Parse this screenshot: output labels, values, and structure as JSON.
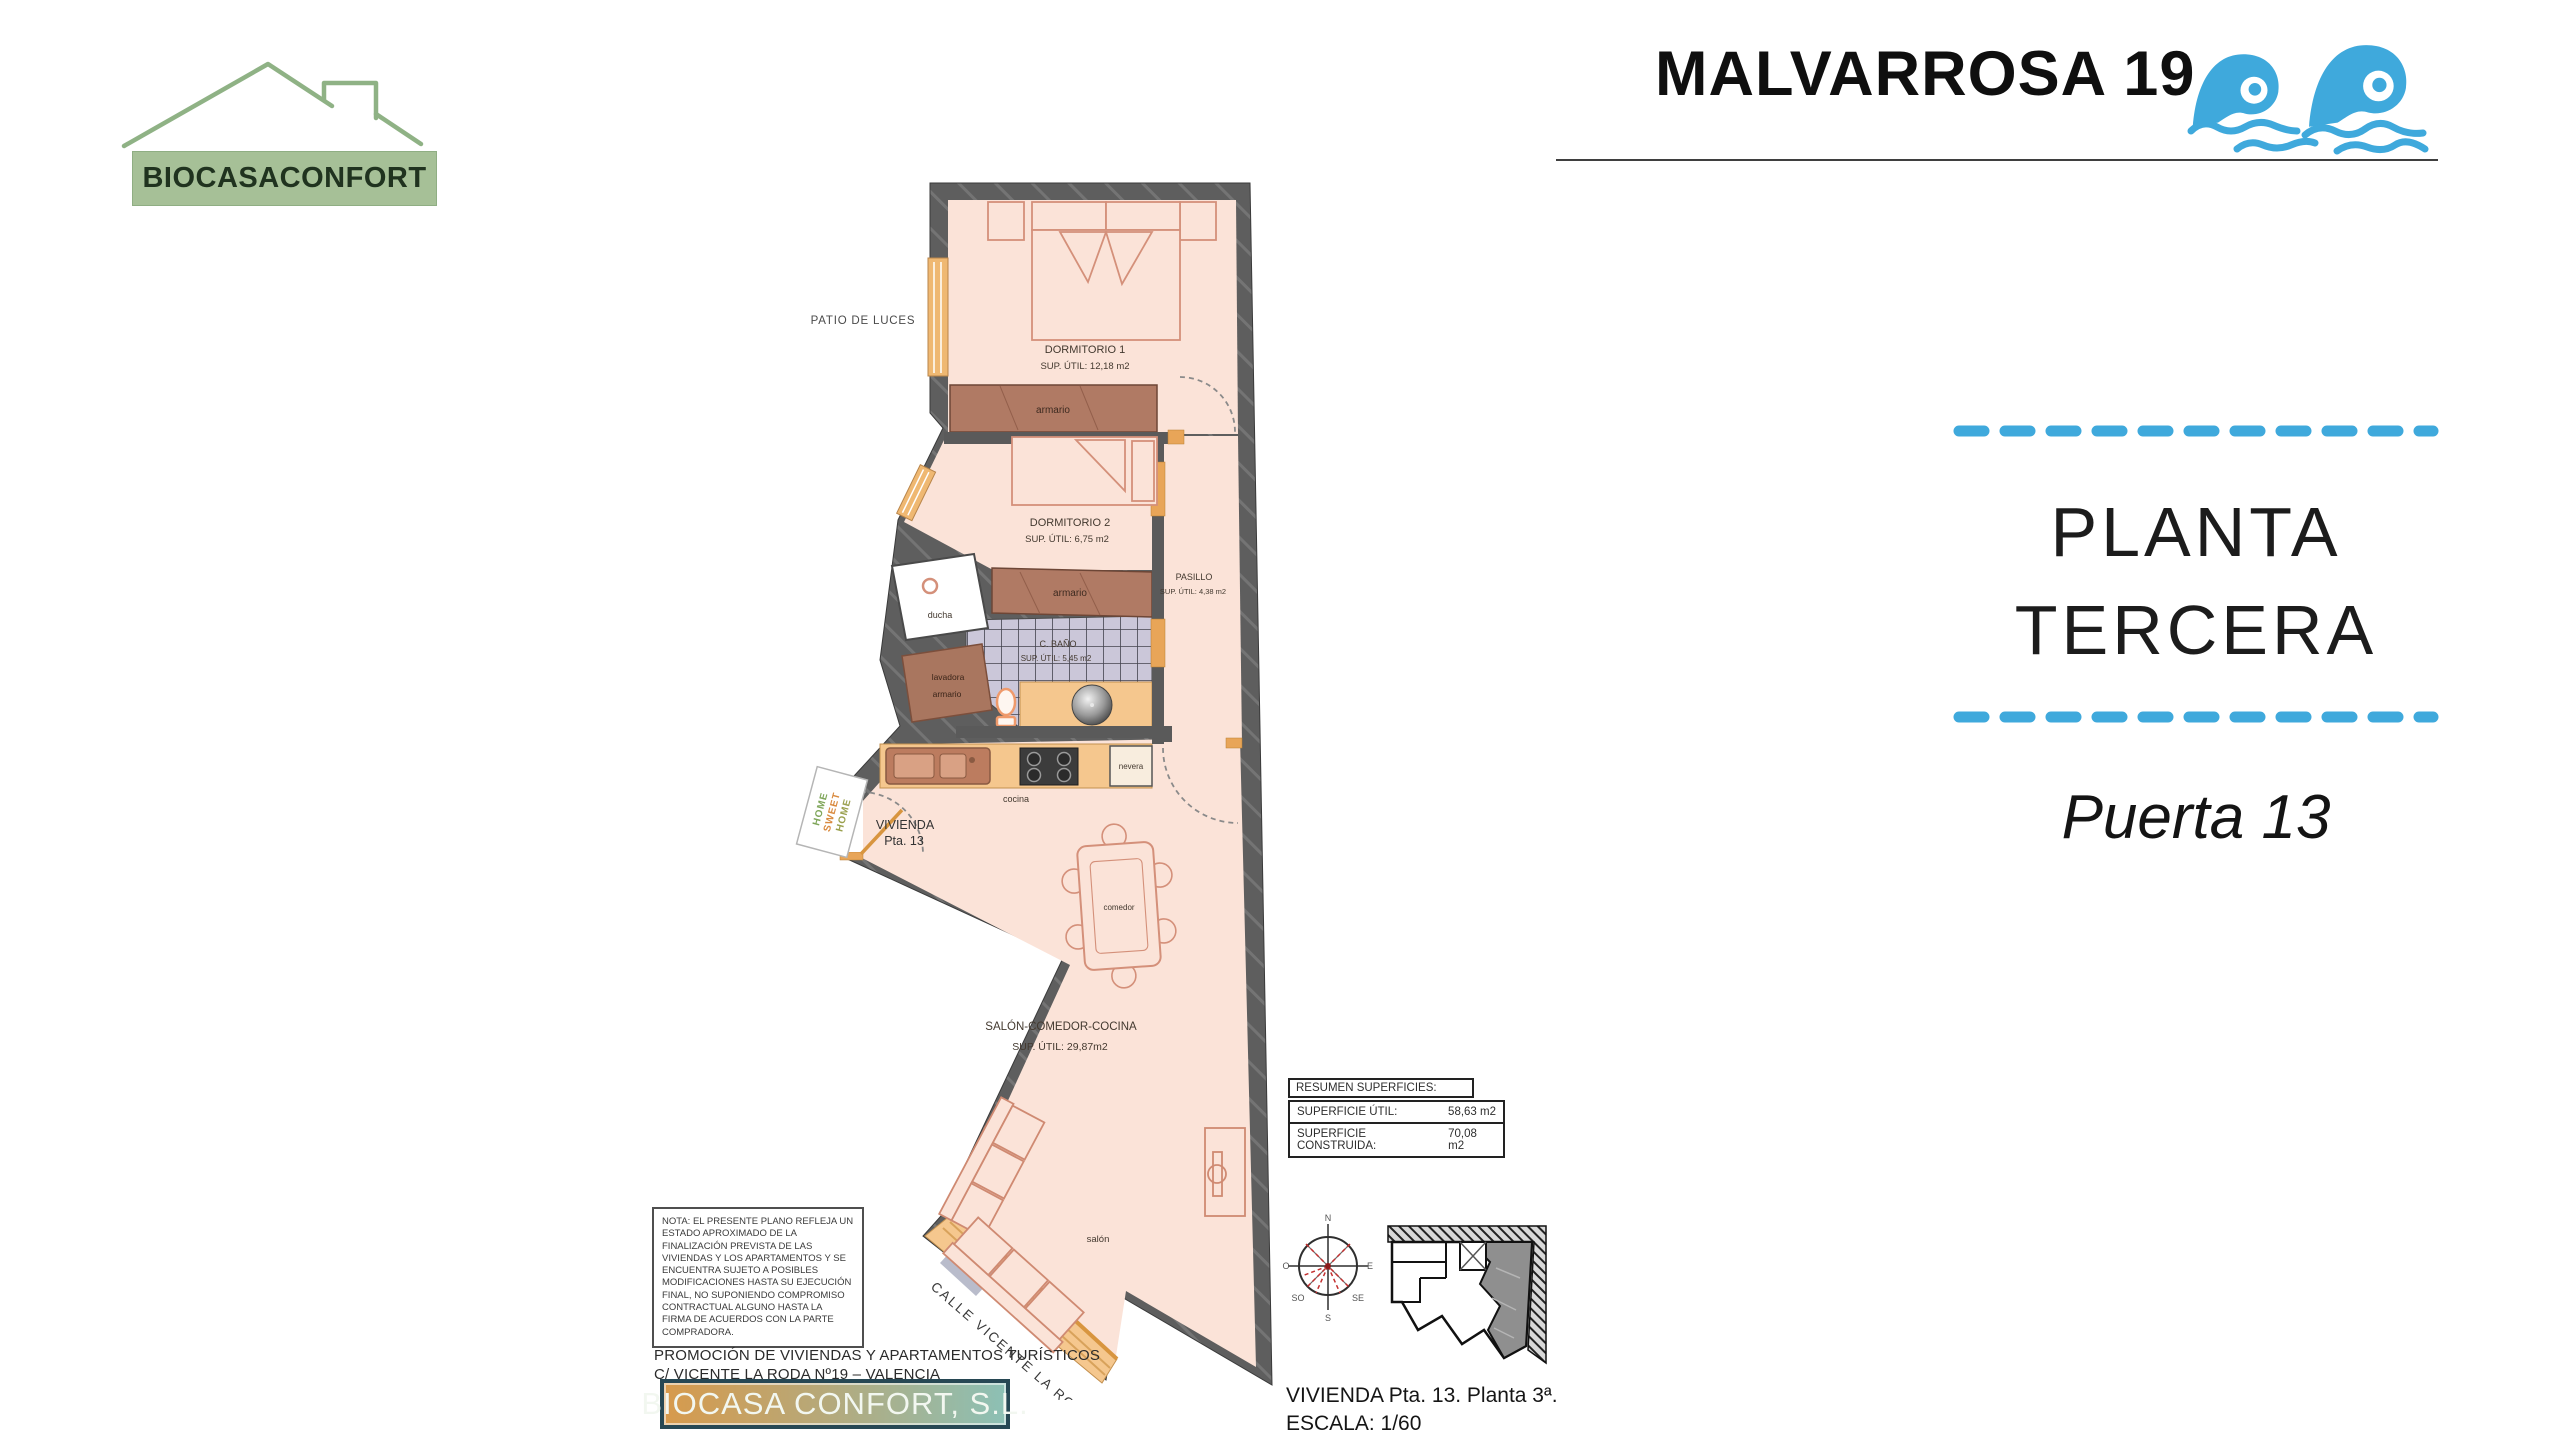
{
  "colors": {
    "accent_blue": "#3FA9DC",
    "logo_green": "#A6C097",
    "wall_gray": "#5E5E5E",
    "floor_pink": "#FBE3D8",
    "closet_brown": "#B07A64",
    "counter_tan": "#F5C78E",
    "tile_lavender": "#CBC7D9",
    "window_orange": "#E8A558"
  },
  "brand": {
    "logo_text": "BIOCASACONFORT"
  },
  "header": {
    "title": "MALVARROSA 19"
  },
  "side_panel": {
    "floor_line1": "PLANTA",
    "floor_line2": "TERCERA",
    "unit_label": "Puerta 13"
  },
  "plan": {
    "patio_label": "PATIO DE LUCES",
    "street_label": "CALLE VICENTE LA RODA",
    "entry": {
      "line1": "VIVIENDA",
      "line2": "Pta. 13"
    },
    "doormat_lines": [
      "HOME",
      "SWEET",
      "HOME"
    ],
    "rooms": {
      "dorm1": {
        "name": "DORMITORIO 1",
        "area": "SUP. ÚTIL: 12,18 m2"
      },
      "dorm2": {
        "name": "DORMITORIO 2",
        "area": "SUP. ÚTIL: 6,75 m2"
      },
      "bano": {
        "name": "C. BAÑO",
        "area": "SUP. ÚTIL: 5,45 m2"
      },
      "pasillo": {
        "name": "PASILLO",
        "area": "SUP. ÚTIL: 4,38 m2"
      },
      "salon": {
        "name": "SALÓN-COMEDOR-COCINA",
        "area": "SUP. ÚTIL: 29,87m2"
      }
    },
    "labels": {
      "armario": "armario",
      "ducha": "ducha",
      "lavadora": "lavadora",
      "cocina": "cocina",
      "nevera": "nevera",
      "comedor": "comedor",
      "salon_small": "salón"
    }
  },
  "summary_table": {
    "header": "RESUMEN SUPERFICIES:",
    "rows": [
      {
        "label": "SUPERFICIE ÚTIL:",
        "value": "58,63 m2"
      },
      {
        "label": "SUPERFICIE CONSTRUIDA:",
        "value": "70,08 m2"
      }
    ]
  },
  "note_box": {
    "text": "NOTA: EL PRESENTE PLANO REFLEJA UN ESTADO APROXIMADO DE LA FINALIZACIÓN PREVISTA DE LAS VIVIENDAS Y LOS APARTAMENTOS Y SE ENCUENTRA SUJETO A POSIBLES MODIFICACIONES HASTA SU EJECUCIÓN FINAL, NO SUPONIENDO COMPROMISO CONTRACTUAL ALGUNO HASTA LA FIRMA DE ACUERDOS CON LA PARTE COMPRADORA."
  },
  "promo": {
    "line1": "PROMOCIÓN DE VIVIENDAS Y APARTAMENTOS TURÍSTICOS",
    "line2": "C/ VICENTE LA RODA Nº19 – VALENCIA"
  },
  "company_box": {
    "name": "BIOCASA CONFORT, S.L."
  },
  "plan_footer": {
    "line1": "VIVIENDA Pta. 13. Planta 3ª.",
    "line2": "ESCALA: 1/60"
  },
  "compass": {
    "n": "N",
    "e": "E",
    "s": "S",
    "o": "O",
    "so": "SO",
    "se": "SE"
  }
}
